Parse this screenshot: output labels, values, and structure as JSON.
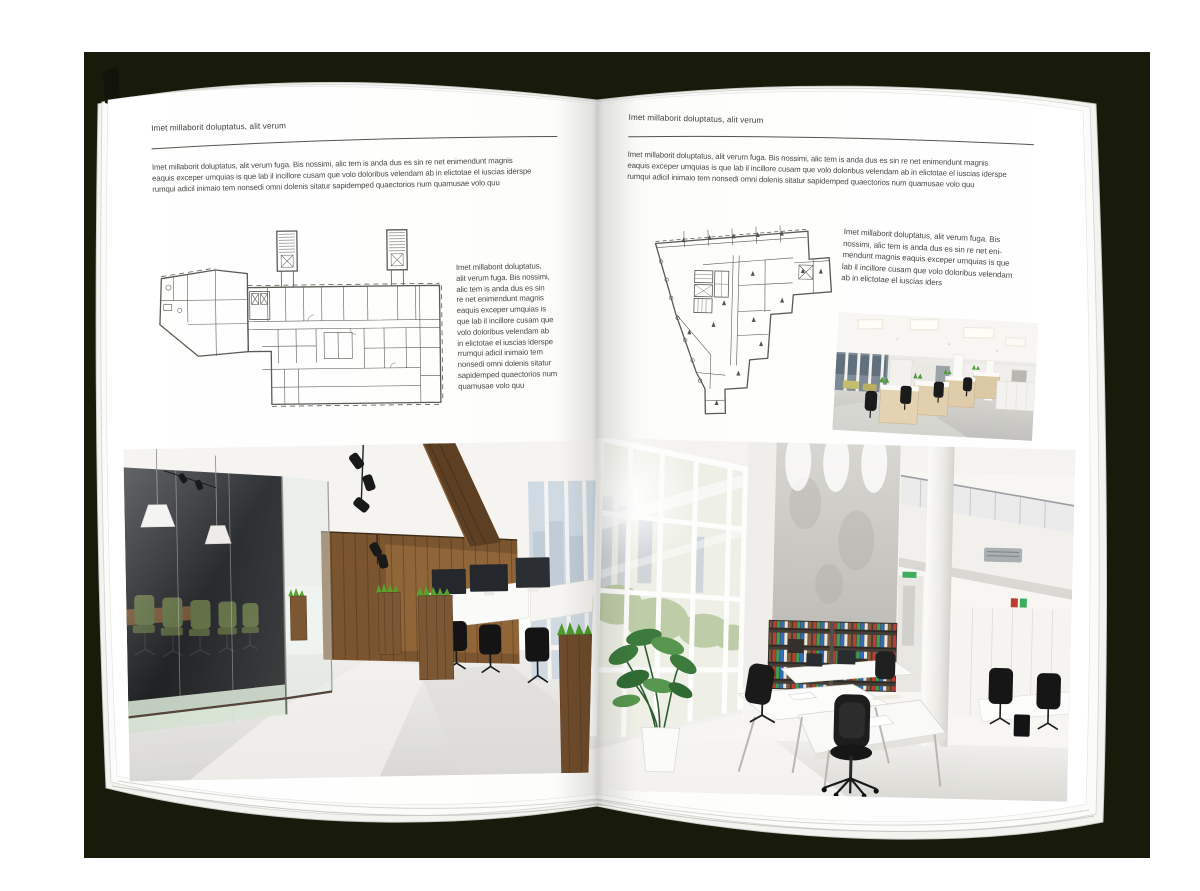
{
  "book": {
    "left_page": {
      "header": "Imet millaborit doluptatus, alit verum",
      "intro_lines": [
        "Imet millaborit doluptatus, alit verum fuga. Bis nossimi, alic tem is anda dus es sin re net enimendunt magnis",
        "eaquis exceper umquias is que lab il incillore cusam que volo doloribus velendam ab in elictotae el iuscias iderspe",
        "rumqui adicil inimaio tem nonsedi omni dolenis sitatur sapidemped quaectorios num quamusae volo quu"
      ],
      "caption_lines": [
        "Imet millaborit doluptatus,",
        "alit verum fuga. Bis nossimi,",
        "alic tem is anda dus es sin",
        "re net enimendunt magnis",
        "eaquis exceper umquias is",
        "que lab il incillore cusam que",
        "volo doloribus velendam ab",
        "in elictotae el iuscias iderspe",
        "rrumqui adicil inimaio tem",
        "nonsedi omni dolenis sitatur",
        "sapidemped quaectorios num",
        "quamusae volo quu"
      ],
      "media": {
        "floor_plan": "office-building-floor-plan-drawing",
        "photo": "loft-office-interior-with-glass-meeting-room"
      }
    },
    "right_page": {
      "header": "Imet millaborit doluptatus, alit verum",
      "intro_lines": [
        "Imet millaborit doluptatus, alit verum fuga. Bis nossimi, alic tem is anda dus es sin re net enimendunt magnis",
        "eaquis exceper umquias is que lab il incillore cusam que volo doloribus velendam ab in elictotae el iuscias iderspe",
        "rumqui adicil inimaio tem nonsedi omni dolenis sitatur sapidemped quaectorios num quamusae volo quu"
      ],
      "caption_lines": [
        "Imet millaborit doluptatus, alit verum fuga. Bis",
        "nossimi, alic tem is anda dus es sin re net eni-",
        "mendunt magnis eaquis exceper umquias is que",
        "lab il incillore cusam que volo doloribus velendam",
        "ab in elictotae el iuscias iders"
      ],
      "media": {
        "floor_plan": "wedge-shaped-building-floor-plan-drawing",
        "photo_small": "white-open-plan-office-with-desks",
        "photo_large": "double-height-bright-office-atrium"
      }
    }
  },
  "colors": {
    "backdrop": "#191b0a",
    "canvas": "#ffffff",
    "paper": "#ffffff",
    "text": "#44433f",
    "rule": "#55544f",
    "plan_line": "#5a5953",
    "wood": "#7a552f",
    "plant_green": "#57a32d",
    "chair_black": "#1b1b1b"
  }
}
